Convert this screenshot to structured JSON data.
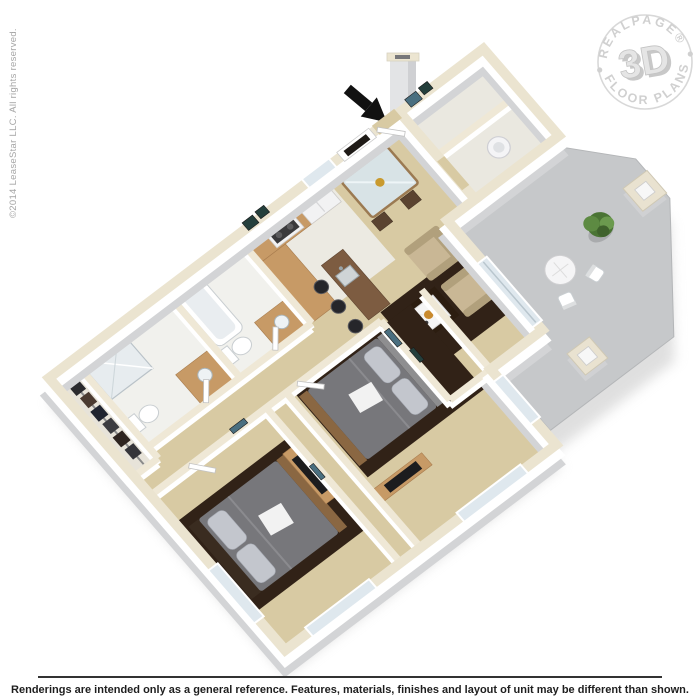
{
  "watermark": {
    "copyright": "©2014 LeaseStar LLC. All rights reserved."
  },
  "badge": {
    "top_text": "REALPAGE®",
    "center_text": "3D",
    "bottom_text": "FLOOR PLANS"
  },
  "footer": {
    "disclaimer": "Renderings are intended only as a general reference. Features, materials, finishes and layout of unit may be different than shown."
  },
  "floor_plan": {
    "type": "3d-isometric-apartment-rendering",
    "rooms": [
      "kitchen",
      "dining-area",
      "living-room",
      "entry",
      "entry-closet",
      "laundry-closet",
      "bathroom-1",
      "bathroom-2",
      "walk-in-closet",
      "hallway",
      "bedroom-1",
      "bedroom-2",
      "patio"
    ],
    "furniture": [
      "kitchen-cabinets",
      "refrigerator",
      "range",
      "breakfast-bar-with-sink",
      "bar-stools",
      "dining-table",
      "dining-chairs",
      "armchairs",
      "coffee-table-with-tray",
      "fireplace",
      "chimney",
      "washer",
      "bathtub",
      "shower",
      "toilets",
      "vanities",
      "queen-bed-1",
      "queen-bed-2",
      "dresser-with-tv-1",
      "dresser-with-tv-2",
      "hanging-clothes",
      "patio-bistro-table",
      "patio-chairs",
      "potted-plant",
      "privacy-pillars"
    ],
    "colors": {
      "background": "#ffffff",
      "carpet": "#d8caa3",
      "kitchen_tile": "#eceae2",
      "bath_tile": "#f1f1ed",
      "patio_concrete": "#c6c8ca",
      "wall_top": "#ebe4d0",
      "wall_face": "#ffffff",
      "wall_shade": "#d3d4d6",
      "wood_cabinet": "#c79a66",
      "bar_counter": "#7d5c41",
      "bed_duvet": "#77777b",
      "rug_brown": "#312217",
      "armchair_beige": "#c9b795",
      "plant_green": "#55803c",
      "arrow_black": "#111111",
      "badge_gray": "#cbcbcb",
      "disclaimer_text": "#1e1e1e",
      "copyright_text": "#a5a5a5"
    }
  }
}
